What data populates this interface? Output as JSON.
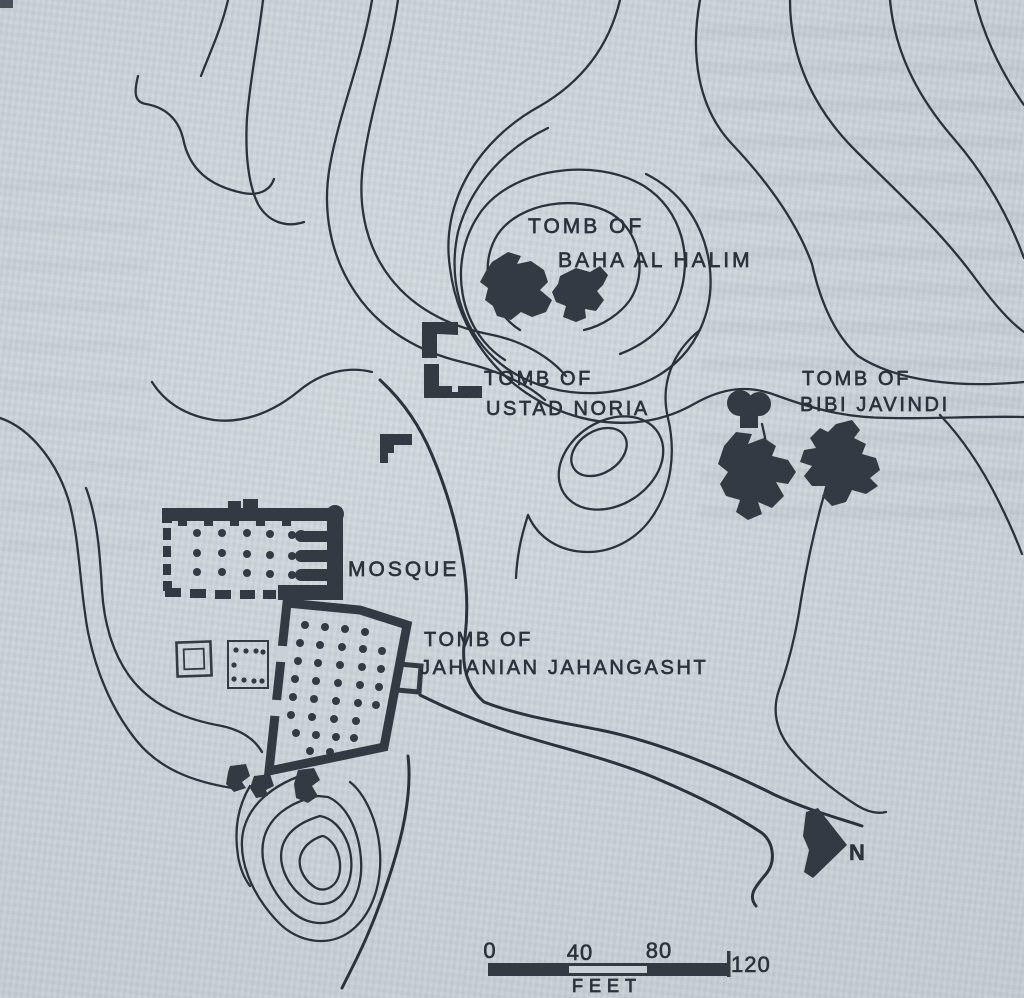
{
  "page": {
    "background_color": "#c8d1d6",
    "ink_color": "#333a44"
  },
  "map": {
    "labels": {
      "baha": {
        "line1": "TOMB OF",
        "line2": "BAHA AL HALIM"
      },
      "ustad": {
        "line1": "TOMB OF",
        "line2": "USTAD NORIA"
      },
      "bibi": {
        "line1": "TOMB OF",
        "line2": "BIBI JAVINDI"
      },
      "mosque": {
        "line1": "MOSQUE"
      },
      "jahanian": {
        "line1": "TOMB OF",
        "line2": "JAHANIAN JAHANGASHT"
      }
    },
    "north_arrow": {
      "label": "N"
    },
    "scale_bar": {
      "tick0": "0",
      "tick40": "40",
      "tick80": "80",
      "tick120": "120",
      "unit": "FEET"
    }
  }
}
